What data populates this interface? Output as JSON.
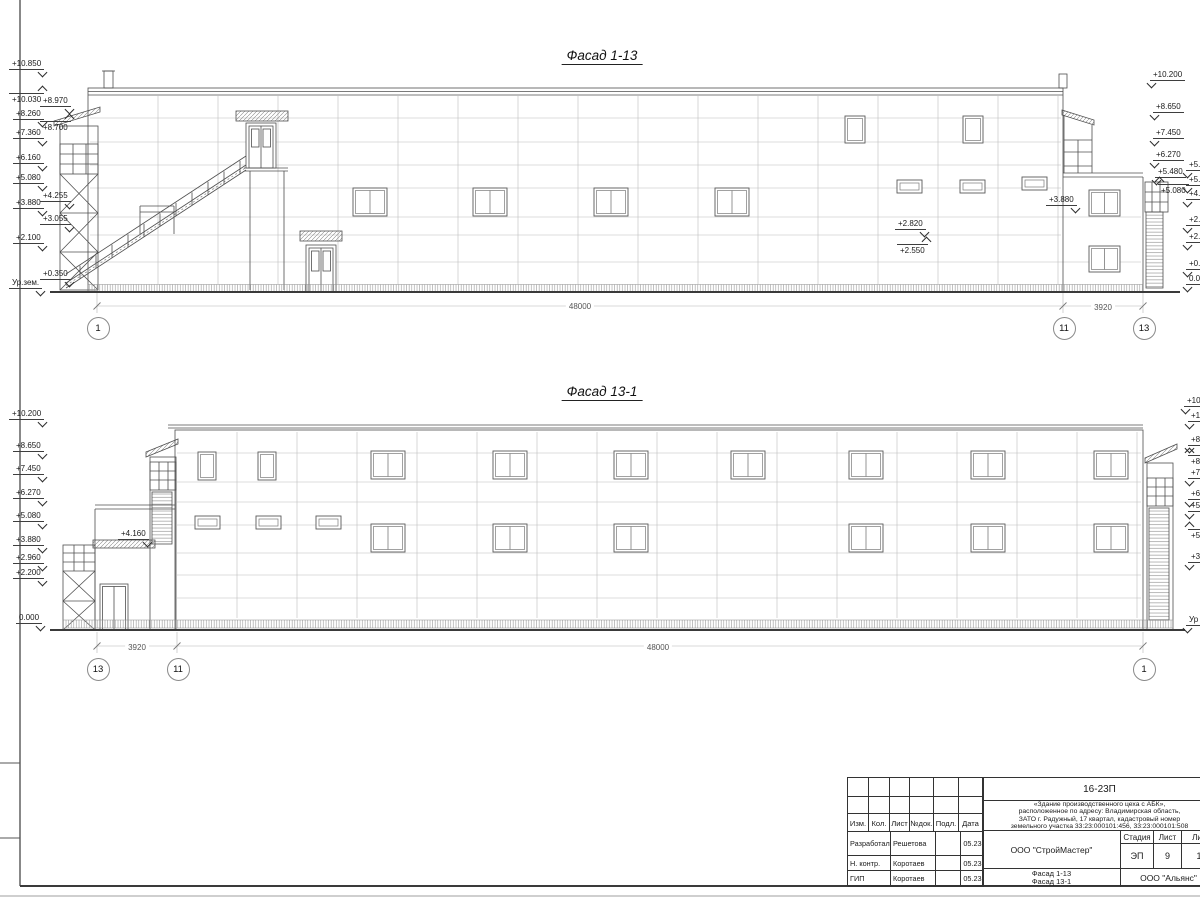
{
  "sheet": {
    "colors": {
      "line": "#4a4a4a",
      "light_line": "#b3b3b3",
      "frame": "#333333",
      "background": "#ffffff"
    }
  },
  "facade_top": {
    "title": "Фасад 1-13",
    "marks": [
      {
        "label": "+10.850",
        "x": 9,
        "y": 59,
        "cls": "rd"
      },
      {
        "label": "+10.030",
        "x": 9,
        "y": 93,
        "cls": "ru"
      },
      {
        "label": "+8.260",
        "x": 13,
        "y": 109,
        "cls": "rd"
      },
      {
        "label": "+7.360",
        "x": 13,
        "y": 128,
        "cls": "rd"
      },
      {
        "label": "+6.160",
        "x": 13,
        "y": 153,
        "cls": "rd"
      },
      {
        "label": "+5.080",
        "x": 13,
        "y": 173,
        "cls": "rd"
      },
      {
        "label": "+3.880",
        "x": 13,
        "y": 198,
        "cls": "rd"
      },
      {
        "label": "+2.100",
        "x": 13,
        "y": 233,
        "cls": "rd"
      },
      {
        "label": "Ур.зем.",
        "x": 9,
        "y": 278,
        "cls": "rd"
      },
      {
        "label": "+8.970",
        "x": 40,
        "y": 96,
        "cls": "rd"
      },
      {
        "label": "+8.700",
        "x": 40,
        "y": 121,
        "cls": "ru"
      },
      {
        "label": "+4.255",
        "x": 40,
        "y": 191,
        "cls": "rd"
      },
      {
        "label": "+3.055",
        "x": 40,
        "y": 214,
        "cls": "rd"
      },
      {
        "label": "+0.350",
        "x": 40,
        "y": 269,
        "cls": "rd"
      },
      {
        "label": "+10.200",
        "x": 1150,
        "y": 70,
        "cls": "ld"
      },
      {
        "label": "+8.650",
        "x": 1153,
        "y": 102,
        "cls": "ld"
      },
      {
        "label": "+7.450",
        "x": 1153,
        "y": 128,
        "cls": "ld"
      },
      {
        "label": "+6.270",
        "x": 1153,
        "y": 150,
        "cls": "ld"
      },
      {
        "label": "+5.480",
        "x": 1155,
        "y": 167,
        "cls": "ld"
      },
      {
        "label": "+5.080",
        "x": 1158,
        "y": 184,
        "cls": "lu"
      },
      {
        "label": "+5.",
        "x": 1186,
        "y": 160,
        "cls": "ld"
      },
      {
        "label": "+5.",
        "x": 1186,
        "y": 175,
        "cls": "ld"
      },
      {
        "label": "+4.",
        "x": 1186,
        "y": 189,
        "cls": "ld"
      },
      {
        "label": "+2.",
        "x": 1186,
        "y": 215,
        "cls": "ld"
      },
      {
        "label": "+2.",
        "x": 1186,
        "y": 232,
        "cls": "ld"
      },
      {
        "label": "+0.",
        "x": 1186,
        "y": 259,
        "cls": "ld"
      },
      {
        "label": "0.0",
        "x": 1186,
        "y": 274,
        "cls": "ld"
      },
      {
        "label": "+3.880",
        "x": 1046,
        "y": 195,
        "cls": "rd"
      },
      {
        "label": "+2.820",
        "x": 895,
        "y": 219,
        "cls": "rd"
      },
      {
        "label": "+2.550",
        "x": 897,
        "y": 244,
        "cls": "ru"
      }
    ],
    "dims": [
      {
        "label": "48000",
        "x": 580,
        "y": 302
      },
      {
        "label": "3920",
        "x": 1103,
        "y": 303
      }
    ],
    "axes": [
      {
        "label": "1",
        "x": 97,
        "y": 327
      },
      {
        "label": "11",
        "x": 1063,
        "y": 327
      },
      {
        "label": "13",
        "x": 1143,
        "y": 327
      }
    ]
  },
  "facade_bottom": {
    "title": "Фасад 13-1",
    "marks": [
      {
        "label": "+10.200",
        "x": 9,
        "y": 409,
        "cls": "rd"
      },
      {
        "label": "+8.650",
        "x": 13,
        "y": 441,
        "cls": "rd"
      },
      {
        "label": "+7.450",
        "x": 13,
        "y": 464,
        "cls": "rd"
      },
      {
        "label": "+6.270",
        "x": 13,
        "y": 488,
        "cls": "rd"
      },
      {
        "label": "+5.080",
        "x": 13,
        "y": 511,
        "cls": "rd"
      },
      {
        "label": "+3.880",
        "x": 13,
        "y": 535,
        "cls": "rd"
      },
      {
        "label": "+2.960",
        "x": 13,
        "y": 553,
        "cls": "rd"
      },
      {
        "label": "+2.200",
        "x": 13,
        "y": 568,
        "cls": "rd"
      },
      {
        "label": "0.000",
        "x": 16,
        "y": 613,
        "cls": "rd"
      },
      {
        "label": "+4.160",
        "x": 118,
        "y": 529,
        "cls": "rd"
      },
      {
        "label": "+10",
        "x": 1184,
        "y": 396,
        "cls": "ld"
      },
      {
        "label": "+1",
        "x": 1188,
        "y": 411,
        "cls": "ld"
      },
      {
        "label": "+8",
        "x": 1188,
        "y": 435,
        "cls": "ld"
      },
      {
        "label": "+8",
        "x": 1188,
        "y": 455,
        "cls": "lu"
      },
      {
        "label": "+7",
        "x": 1188,
        "y": 468,
        "cls": "ld"
      },
      {
        "label": "+6",
        "x": 1188,
        "y": 489,
        "cls": "ld"
      },
      {
        "label": "+5",
        "x": 1188,
        "y": 501,
        "cls": "ld"
      },
      {
        "label": "+5",
        "x": 1188,
        "y": 529,
        "cls": "lu"
      },
      {
        "label": "+3",
        "x": 1188,
        "y": 552,
        "cls": "ld"
      },
      {
        "label": "Ур",
        "x": 1186,
        "y": 615,
        "cls": "ld"
      }
    ],
    "dims": [
      {
        "label": "3920",
        "x": 137,
        "y": 643
      },
      {
        "label": "48000",
        "x": 658,
        "y": 643
      }
    ],
    "axes": [
      {
        "label": "13",
        "x": 97,
        "y": 668
      },
      {
        "label": "11",
        "x": 177,
        "y": 668
      },
      {
        "label": "1",
        "x": 1143,
        "y": 668
      }
    ]
  },
  "title_block": {
    "code": "16-23П",
    "description_lines": [
      "«Здание производственного цеха с АБК»,",
      "расположенное по адресу: Владимирская область,",
      "ЗАТО г. Радужный, 17 квартал, кадастровый номер",
      "земельного участка 33:23:000101:456, 33:23:000101:508"
    ],
    "columns": [
      {
        "label": "Изм.",
        "w": 21
      },
      {
        "label": "Кол.",
        "w": 21
      },
      {
        "label": "Лист",
        "w": 20
      },
      {
        "label": "№док.",
        "w": 24
      },
      {
        "label": "Подл.",
        "w": 25
      },
      {
        "label": "Дата",
        "w": 24
      }
    ],
    "rows": [
      {
        "role": "Разработал",
        "name": "Решетова",
        "date": "05.23",
        "y": 53,
        "h": 25
      },
      {
        "role": "Н. контр.",
        "name": "Коротаев",
        "date": "05.23",
        "y": 78,
        "h": 15
      },
      {
        "role": "ГИП",
        "name": "Коротаев",
        "date": "05.23",
        "y": 93,
        "h": 16
      }
    ],
    "org": "ООО \"СтройМастер\"",
    "stage_label": "Стадия",
    "sheet_label": "Лист",
    "sheets_label": "Лис",
    "stage": "ЭП",
    "sheet": "9",
    "sheets": "1",
    "drawing_title_lines": [
      "Фасад 1-13",
      "Фасад 13-1"
    ],
    "org2": "ООО \"Альянс\""
  }
}
